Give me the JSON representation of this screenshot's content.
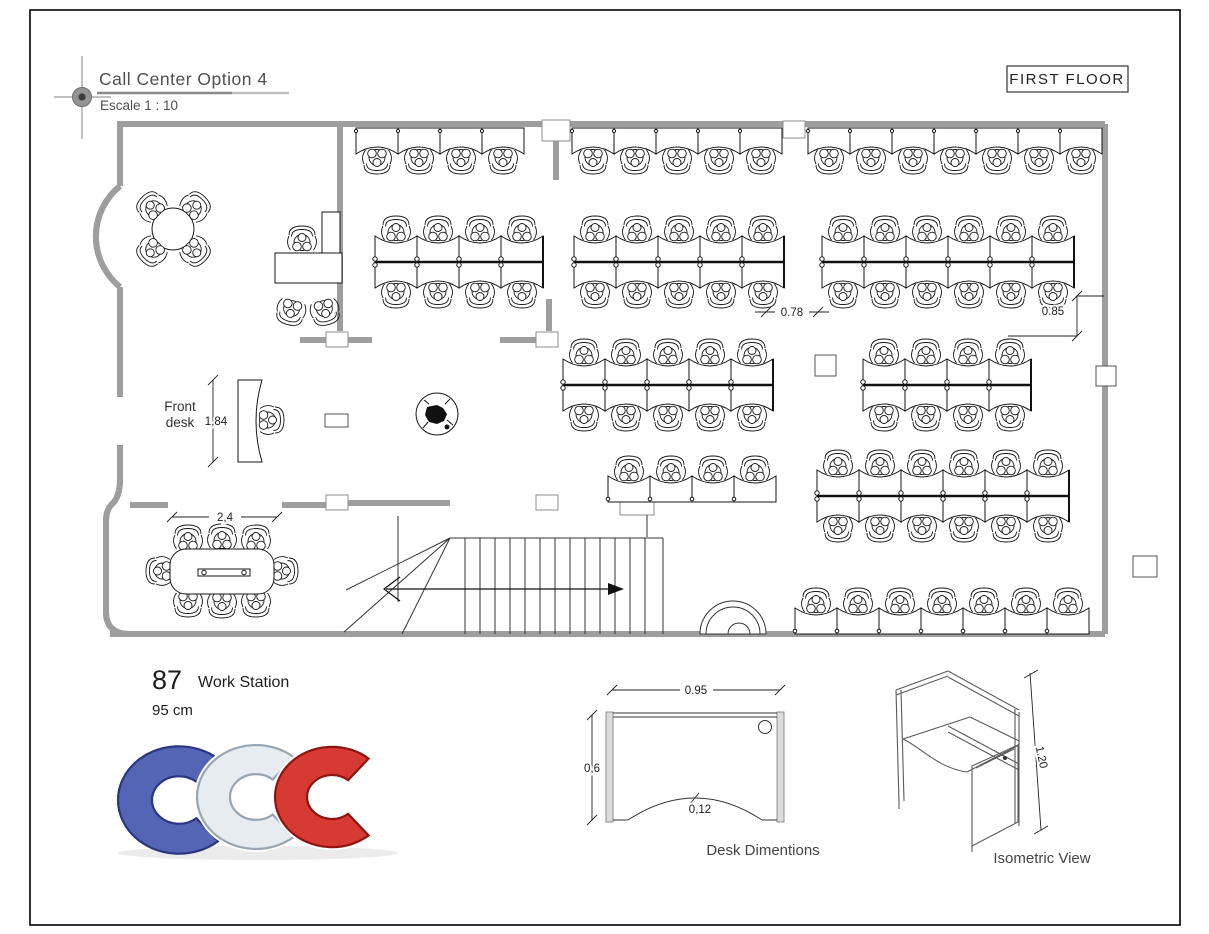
{
  "header": {
    "title": "Call Center Option 4",
    "scale": "Escale 1 : 10",
    "floor": "FIRST FLOOR"
  },
  "labels": {
    "front_desk_line1": "Front",
    "front_desk_line2": "desk",
    "desk_diagram": "Desk Dimentions",
    "isometric": "Isometric View",
    "station_count": "87",
    "station_label": "Work Station",
    "station_size": "95 cm"
  },
  "dimensions": {
    "front_desk_height": "1,84",
    "conference_width": "2,4",
    "aisle": "0.78",
    "wall_offset": "0.85",
    "desk_width": "0.95",
    "desk_depth": "0,6",
    "desk_notch": "0,12",
    "cubicle_height": "1.20"
  },
  "logo": {
    "letters": "CCC",
    "colors": {
      "blue": "#5565b5",
      "blue_edge": "#2a3780",
      "silver": "#e7ecf0",
      "silver_edge": "#96a5b1",
      "red": "#d63a32",
      "red_edge": "#8e1410"
    }
  },
  "plan": {
    "station_width": 42,
    "wall_rows": [
      {
        "y": 128,
        "groups": [
          [
            356,
            4
          ],
          [
            572,
            5
          ],
          [
            808,
            7
          ]
        ]
      }
    ],
    "clusters": [
      [
        375,
        212,
        4
      ],
      [
        574,
        212,
        5
      ],
      [
        822,
        212,
        6
      ],
      [
        563,
        335,
        5
      ],
      [
        863,
        335,
        4
      ],
      [
        817,
        446,
        6
      ]
    ],
    "single_rows": [
      [
        608,
        452,
        4
      ],
      [
        795,
        584,
        7
      ]
    ]
  }
}
